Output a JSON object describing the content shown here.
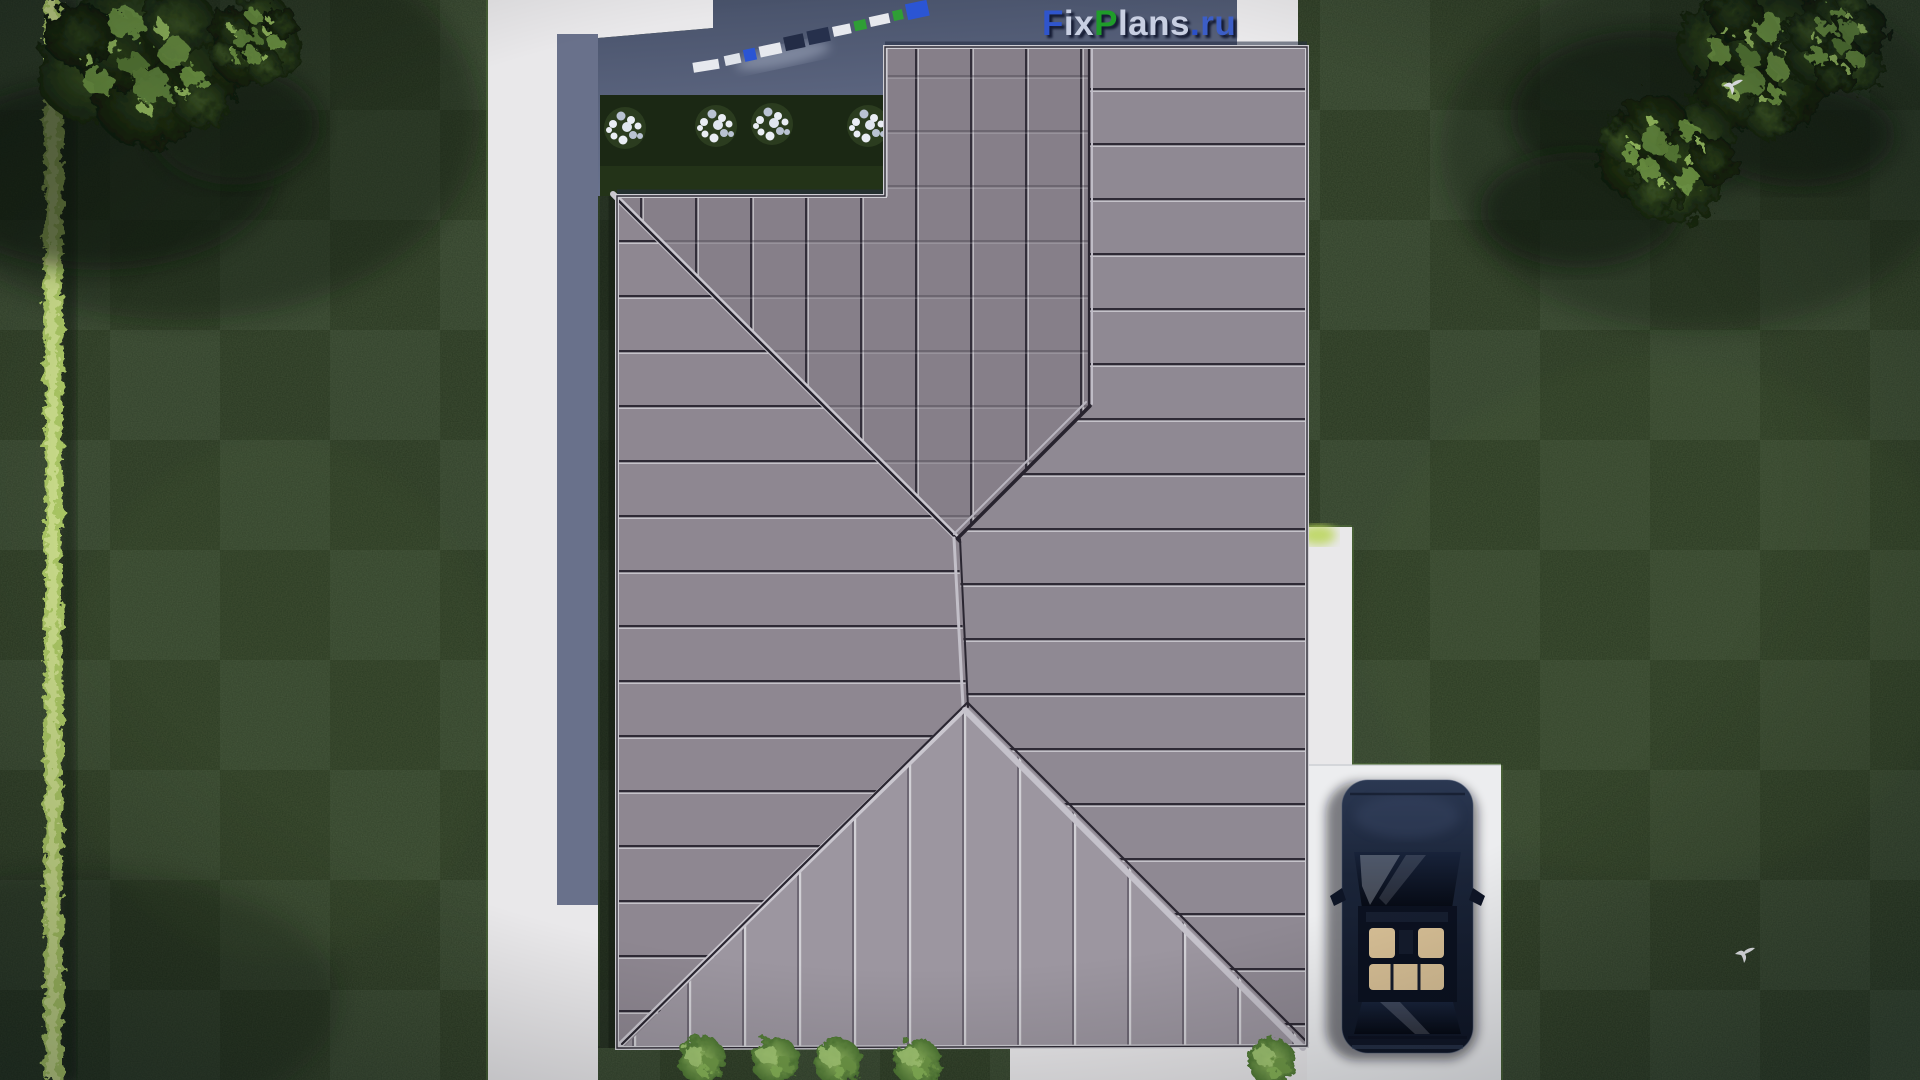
{
  "scene": {
    "name": "aerial-top-view-house-roof-plan-render",
    "width": 1920,
    "height": 1080
  },
  "watermark": {
    "text": "FixPlans.ru",
    "segments": [
      {
        "text": "F",
        "color": "#2f55cc"
      },
      {
        "text": "ix",
        "color": "#c8cfe2"
      },
      {
        "text": "P",
        "color": "#1f9c2a"
      },
      {
        "text": "lans",
        "color": "#c8cfe2"
      },
      {
        "text": ".",
        "color": "#2b50c8"
      },
      {
        "text": "ru",
        "color": "#3c5ec7"
      }
    ]
  },
  "palette": {
    "grass": "#293722",
    "grass_light": "#3c5129",
    "hedge": "#a8c464",
    "pavement": "#e9e8ea",
    "pavement_shadow": "#545e78",
    "driveway": "#ecedef",
    "roof_base": "#8a838d",
    "roof_light": "#9c96a0",
    "roof_dark": "#867f89",
    "seam_dark": "#2e2a35",
    "seam_light": "#d6d5da",
    "garden_bed": "#1b2814",
    "shrub_flower": "#e9edf4",
    "bush": "#7fad52",
    "tree_dark": "#16230f",
    "tree_light": "#7ba34c",
    "car_body": "#16202f",
    "car_glass": "#0b1120",
    "car_interior": "#d8c096",
    "bird": "#f4f6f8"
  }
}
